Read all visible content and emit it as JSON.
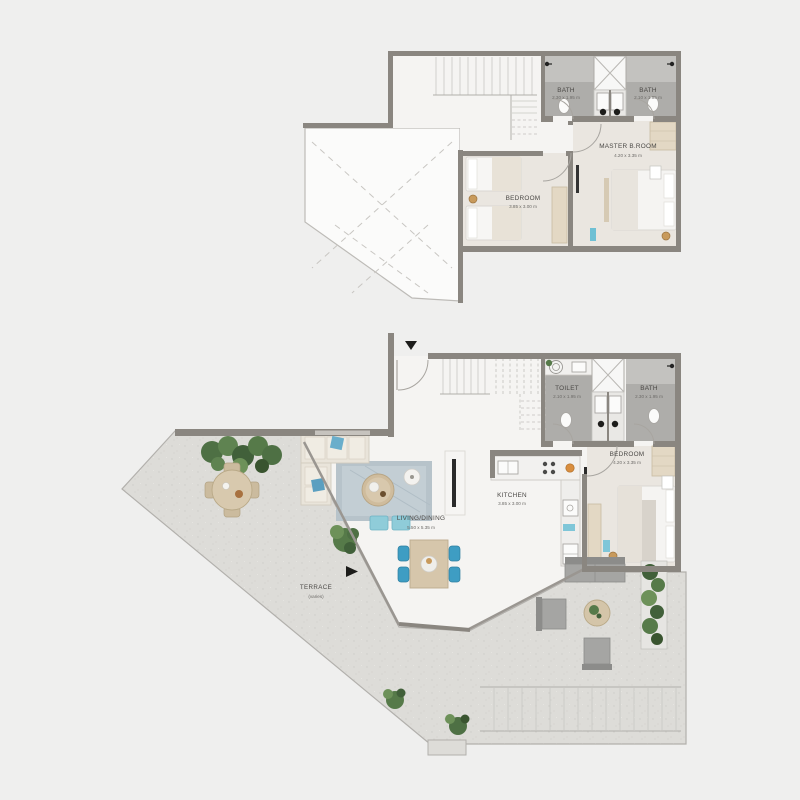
{
  "document": {
    "type": "apartment-duplex-floor-plan",
    "background": "#efefee"
  },
  "plan": {
    "upper": {
      "rooms": [
        {
          "id": "bath-1",
          "name": "BATH",
          "dims": "2.30 x 1.95 m"
        },
        {
          "id": "bath-2",
          "name": "BATH",
          "dims": "2.10 x 1.95 m"
        },
        {
          "id": "master-bedroom",
          "name": "MASTER B.ROOM",
          "dims": "4.20 x 3.35 m"
        },
        {
          "id": "bedroom",
          "name": "BEDROOM",
          "dims": "3.85 x 3.00 m"
        }
      ]
    },
    "lower": {
      "rooms": [
        {
          "id": "toilet",
          "name": "TOILET",
          "dims": "2.10 x 1.95 m"
        },
        {
          "id": "bath",
          "name": "BATH",
          "dims": "2.30 x 1.95 m"
        },
        {
          "id": "bedroom",
          "name": "BEDROOM",
          "dims": "4.20 x 3.35 m"
        },
        {
          "id": "kitchen",
          "name": "KITCHEN",
          "dims": "3.85 x 3.00 m"
        },
        {
          "id": "living-dining",
          "name": "LIVING/DINING",
          "dims": "5.50 x 5.35 m"
        },
        {
          "id": "terrace",
          "name": "TERRACE",
          "dims": "(varies)"
        }
      ]
    },
    "icons": {
      "entry_arrow": "triangle-down",
      "terrace_arrow": "triangle-right"
    },
    "colors": {
      "wall": "#8a8680",
      "indoor_floor": "#f5f4f2",
      "bedroom_floor": "#eae6e0",
      "bath_floor": "#aeadaa",
      "terrace_floor": "#dddcd8",
      "accent_blue": "#3e9dc3",
      "accent_teal": "#7fc6d8",
      "plant_green": "#567a49",
      "wood_beige": "#d6c6ab",
      "gold": "#c89a5c"
    }
  }
}
